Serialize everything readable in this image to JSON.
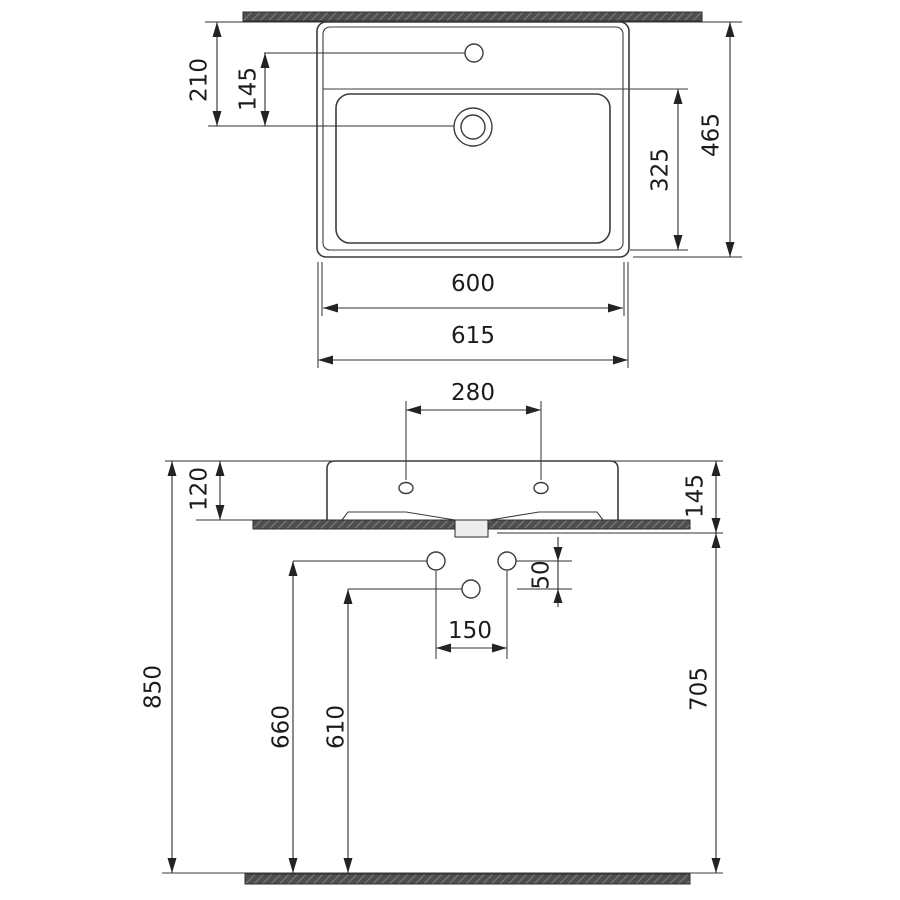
{
  "drawing": {
    "colors": {
      "line": "#3c3c3c",
      "hatch_fill": "#4e4e4e",
      "background": "#ffffff"
    },
    "top_view": {
      "faucet_setback": "210",
      "faucet_to_drain": "145",
      "basin_depth": "325",
      "overall_depth": "465",
      "basin_width": "600",
      "overall_width": "615"
    },
    "front_view": {
      "hole_spacing": "280",
      "apron_height": "120",
      "rim_to_underside": "145",
      "supply_offset": "50",
      "supply_spacing": "150",
      "rim_height": "850",
      "supply_height": "660",
      "drain_height": "610",
      "underside_height": "705"
    }
  }
}
